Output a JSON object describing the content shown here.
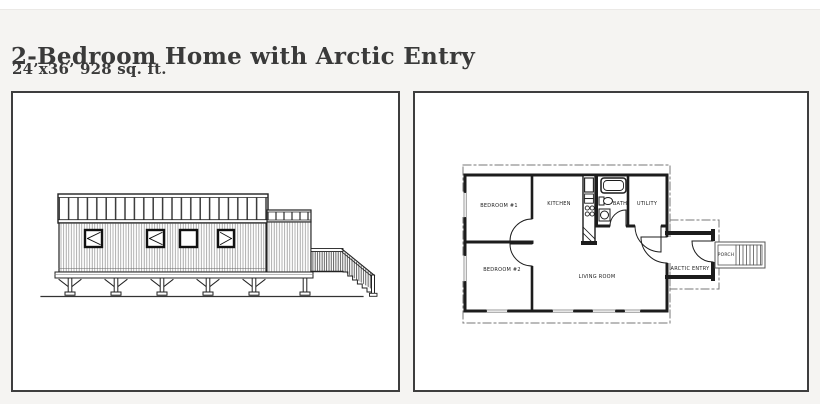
{
  "header": {
    "title": "2-Bedroom Home with Arctic Entry",
    "subtitle": "24’x36’ 928 sq. ft."
  },
  "colors": {
    "page_background": "#f5f4f2",
    "top_strip": "#ffffff",
    "panel_background": "#ffffff",
    "panel_border": "#3e3e3e",
    "wall_line": "#1c1c1c",
    "thin_line": "#555555",
    "window_mark": "#999999",
    "title_text": "#3a3a3a"
  },
  "floor_plan": {
    "rooms": [
      {
        "id": "bedroom-1",
        "label": "BEDROOM #1"
      },
      {
        "id": "kitchen",
        "label": "KITCHEN"
      },
      {
        "id": "bath",
        "label": "BATH"
      },
      {
        "id": "utility",
        "label": "UTILITY"
      },
      {
        "id": "bedroom-2",
        "label": "BEDROOM #2"
      },
      {
        "id": "living-room",
        "label": "LIVING ROOM"
      },
      {
        "id": "arctic-entry",
        "label": "ARCTIC ENTRY"
      },
      {
        "id": "porch",
        "label": "PORCH"
      }
    ]
  }
}
